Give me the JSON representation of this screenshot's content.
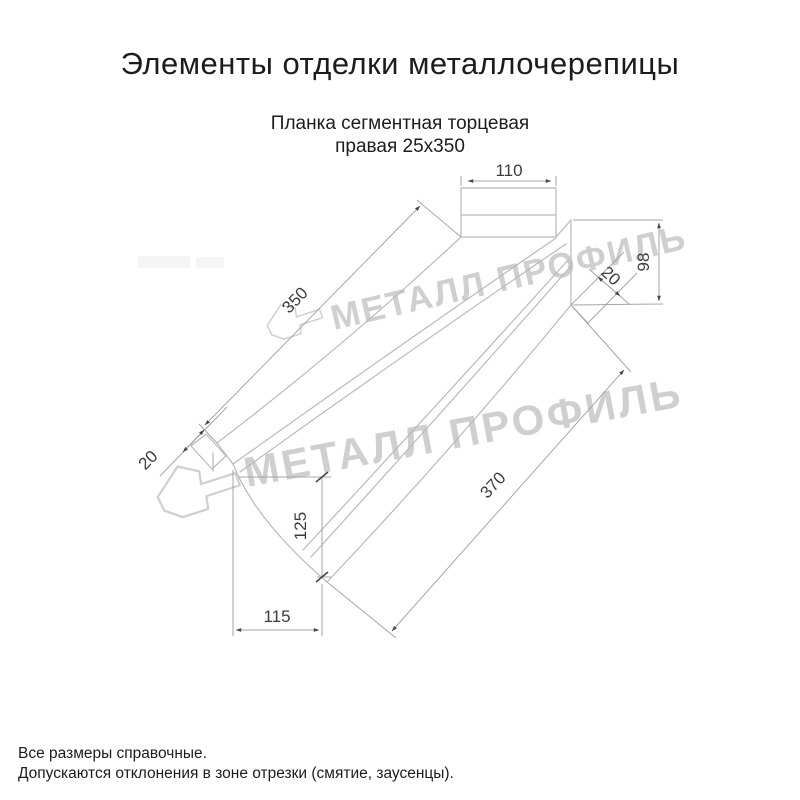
{
  "header": {
    "title": "Элементы отделки металлочерепицы"
  },
  "drawing": {
    "subtitle_line1": "Планка сегментная торцевая",
    "subtitle_line2": "правая 25х350",
    "dimensions": {
      "top_width": "110",
      "length_top": "350",
      "left_fold": "20",
      "right_fold": "20",
      "right_height": "98",
      "left_height": "125",
      "bottom_width": "115",
      "length_bottom": "370"
    },
    "line_color": "#b9b9b9",
    "dimension_color": "#a6a6a6"
  },
  "watermark": {
    "text": "МЕТАЛЛ ПРОФИЛЬ",
    "color": "#cfcfcf"
  },
  "footer": {
    "note1": "Все размеры справочные.",
    "note2": "Допускаются отклонения в зоне отрезки (смятие, заусенцы)."
  }
}
